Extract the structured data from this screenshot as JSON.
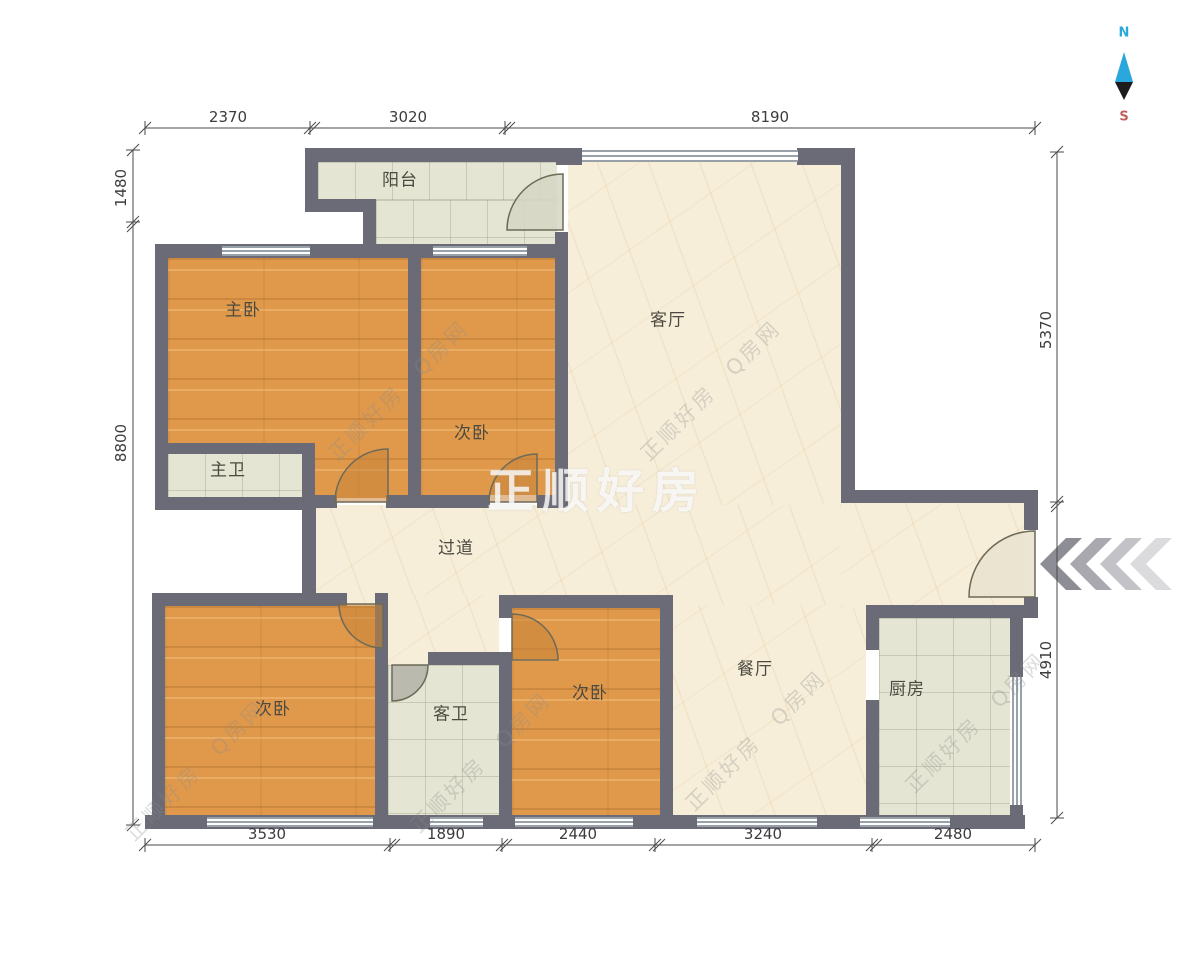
{
  "compass": {
    "north": "N",
    "south": "S"
  },
  "rooms": {
    "balcony": {
      "label": "阳台"
    },
    "master_bedroom name": "",
    "master_bedroom": {
      "label": "主卧"
    },
    "bedroom_top": {
      "label": "次卧"
    },
    "living": {
      "label": "客厅"
    },
    "master_bath": {
      "label": "主卫"
    },
    "hallway": {
      "label": "过道"
    },
    "bedroom_left": {
      "label": "次卧"
    },
    "guest_bath": {
      "label": "客卫"
    },
    "bedroom_mid": {
      "label": "次卧"
    },
    "dining": {
      "label": "餐厅"
    },
    "kitchen": {
      "label": "厨房"
    }
  },
  "dimensions": {
    "top": [
      "2370",
      "3020",
      "8190"
    ],
    "bottom": [
      "3530",
      "1890",
      "2440",
      "3240",
      "2480"
    ],
    "left": [
      "1480",
      "8800"
    ],
    "right": [
      "5370",
      "4910"
    ]
  },
  "watermark": {
    "brand": "正顺好房",
    "diagonal": "正顺好房　Q房网"
  },
  "colors": {
    "wall": "#6b6b77",
    "wood_floor": "#e0994b",
    "tile_floor": "#e4e5d2",
    "marble_floor": "#f7eeda",
    "north": "#2aa7dc",
    "south": "#c0605c"
  }
}
